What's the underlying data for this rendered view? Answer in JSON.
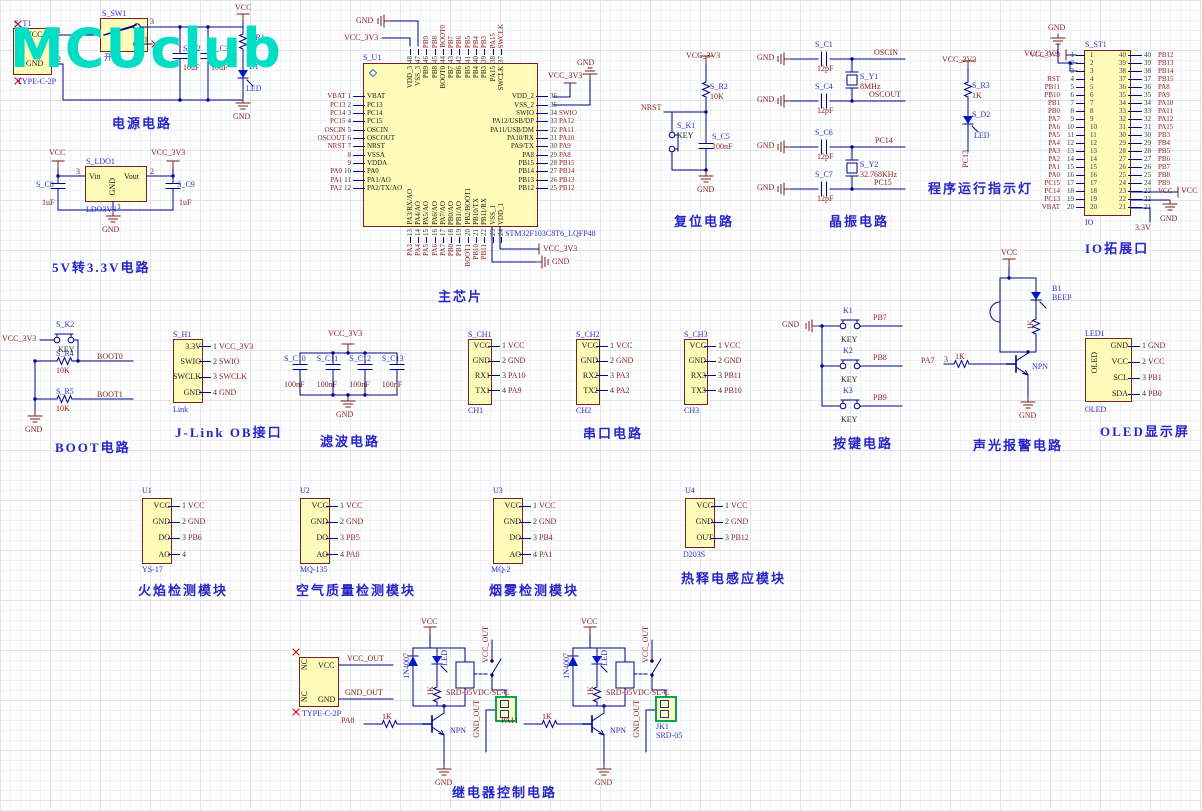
{
  "logo": {
    "text": "MCUclub"
  },
  "power": {
    "title": "电源电路",
    "vcc": "VCC",
    "gnd": "GND",
    "t1_ref": "S_T1",
    "t1_part": "TYPE-C-2P",
    "t1_pin1": "VCC",
    "t1_pin2": "GND",
    "n1": "1",
    "n2": "2",
    "sw_ref": "S_SW1",
    "sw_label": "开关",
    "sw_n3": "3",
    "sw_n1": "1",
    "c2_ref": "S_C2",
    "c2_val": "10uF",
    "c3_ref": "S_C3",
    "c3_val": "10uF",
    "r1_ref": "S_R1",
    "r1_val": "1K",
    "d1_ref": "D1",
    "d1_val": "LED"
  },
  "ldo": {
    "title": "5V转3.3V电路",
    "vcc": "VCC",
    "vcc3": "VCC_3V3",
    "gnd": "GND",
    "ref": "S_LDO1",
    "part": "LDO3V3",
    "vin": "Vin",
    "vout": "Vout",
    "pgnd": "GND",
    "n3": "3",
    "n2": "2",
    "n1": "1",
    "c8_ref": "S_C8",
    "c8_val": "1uF",
    "c9_ref": "S_C9",
    "c9_val": "1uF"
  },
  "chip": {
    "title": "主芯片",
    "ref": "S_U1",
    "part": "STM32F103C8T6_LQFP48",
    "gnd_top": "GND",
    "vcc_top": "VCC_3V3",
    "vcc_right": "VCC_3V3",
    "gnd_right": "GND",
    "vcc_bot": "VCC_3V3",
    "gnd_bot": "GND",
    "left": [
      {
        "num": "1",
        "name": "VBAT",
        "net": "VBAT"
      },
      {
        "num": "2",
        "name": "PC13",
        "net": "PC13"
      },
      {
        "num": "3",
        "name": "PC14",
        "net": "PC14"
      },
      {
        "num": "4",
        "name": "PC15",
        "net": "PC15"
      },
      {
        "num": "5",
        "name": "OSCIN",
        "net": "OSCIN"
      },
      {
        "num": "6",
        "name": "OSCOUT",
        "net": "OSCOUT"
      },
      {
        "num": "7",
        "name": "NRST",
        "net": "NRST"
      },
      {
        "num": "8",
        "name": "VSSA",
        "net": ""
      },
      {
        "num": "9",
        "name": "VDDA",
        "net": ""
      },
      {
        "num": "10",
        "name": "PA0",
        "net": "PA0"
      },
      {
        "num": "11",
        "name": "PA1/AO",
        "net": "PA1"
      },
      {
        "num": "12",
        "name": "PA2/TX/AO",
        "net": "PA2"
      }
    ],
    "top": [
      {
        "num": "48",
        "name": "VDD_3",
        "net": ""
      },
      {
        "num": "47",
        "name": "VSS_3",
        "net": ""
      },
      {
        "num": "46",
        "name": "PB9",
        "net": "PB9"
      },
      {
        "num": "45",
        "name": "PB8",
        "net": "PB8"
      },
      {
        "num": "44",
        "name": "BOOT0",
        "net": "BOOT0"
      },
      {
        "num": "43",
        "name": "PB7",
        "net": "PB7"
      },
      {
        "num": "42",
        "name": "PB6",
        "net": "PB6"
      },
      {
        "num": "41",
        "name": "PB5",
        "net": "PB5"
      },
      {
        "num": "40",
        "name": "PB4",
        "net": "PB4"
      },
      {
        "num": "39",
        "name": "PB3",
        "net": "PB3"
      },
      {
        "num": "38",
        "name": "PA15",
        "net": "PA15"
      },
      {
        "num": "37",
        "name": "SWCLK",
        "net": "SWCLK"
      }
    ],
    "right": [
      {
        "num": "36",
        "name": "VDD_2",
        "net": ""
      },
      {
        "num": "35",
        "name": "VSS_2",
        "net": ""
      },
      {
        "num": "34",
        "name": "SWIO",
        "net": "SWIO"
      },
      {
        "num": "33",
        "name": "PA12/USB/DP",
        "net": "PA12"
      },
      {
        "num": "32",
        "name": "PA11/USB/DM",
        "net": "PA11"
      },
      {
        "num": "31",
        "name": "PA10/RX",
        "net": "PA10"
      },
      {
        "num": "30",
        "name": "PA9/TX",
        "net": "PA9"
      },
      {
        "num": "29",
        "name": "PA8",
        "net": "PA8"
      },
      {
        "num": "28",
        "name": "PB15",
        "net": "PB15"
      },
      {
        "num": "27",
        "name": "PB14",
        "net": "PB14"
      },
      {
        "num": "26",
        "name": "PB13",
        "net": "PB13"
      },
      {
        "num": "25",
        "name": "PB12",
        "net": "PB12"
      }
    ],
    "bottom": [
      {
        "num": "13",
        "name": "PA3/RX/AO",
        "net": "PA3"
      },
      {
        "num": "14",
        "name": "PA4/AO",
        "net": "PA4"
      },
      {
        "num": "15",
        "name": "PA5/AO",
        "net": "PA5"
      },
      {
        "num": "16",
        "name": "PA6/AO",
        "net": "PA6"
      },
      {
        "num": "17",
        "name": "PA7/AO",
        "net": "PA7"
      },
      {
        "num": "18",
        "name": "PB0/AO",
        "net": "PB0"
      },
      {
        "num": "19",
        "name": "PB1/AO",
        "net": "PB1"
      },
      {
        "num": "20",
        "name": "PB2/BOOT1",
        "net": "BOOT1"
      },
      {
        "num": "21",
        "name": "PB10/TX",
        "net": "PB10"
      },
      {
        "num": "22",
        "name": "PB11/RX",
        "net": "PB11"
      },
      {
        "num": "23",
        "name": "VSS_1",
        "net": ""
      },
      {
        "num": "24",
        "name": "VDD_1",
        "net": ""
      }
    ]
  },
  "reset": {
    "title": "复位电路",
    "vcc3": "VCC_3V3",
    "r_ref": "S_R2",
    "r_val": "10K",
    "net": "NRST",
    "k_ref": "S_K1",
    "k_label": "KEY",
    "c_ref": "S_C5",
    "c_val": "100nF",
    "gnd": "GND"
  },
  "crystal": {
    "title": "晶振电路",
    "gnd": "GND",
    "g1": {
      "c_top_ref": "S_C1",
      "c_top_val": "12pF",
      "c_bot_ref": "S_C4",
      "c_bot_val": "12pF",
      "y_ref": "S_Y1",
      "y_val": "8MHz",
      "net_top": "OSCIN",
      "net_bot": "OSCOUT"
    },
    "g2": {
      "c_top_ref": "S_C6",
      "c_top_val": "12pF",
      "c_bot_ref": "S_C7",
      "c_bot_val": "12pF",
      "y_ref": "S_Y2",
      "y_val": "32.768KHz",
      "net_top": "PC14",
      "net_bot": "PC15"
    }
  },
  "runled": {
    "title": "程序运行指示灯",
    "vcc3": "VCC_3V3",
    "r_ref": "S_R3",
    "r_val": "1K",
    "d_ref": "S_D2",
    "d_val": "LED",
    "net": "PC13"
  },
  "io": {
    "title": "IO拓展口",
    "ref": "S_ST1",
    "name": "IO",
    "gnd_top": "GND",
    "vcc3": "VCC_3V3",
    "vcc": "VCC",
    "gnd": "GND",
    "v33": "3.3V",
    "left": [
      {
        "num": "1",
        "net": "VCC_3V3"
      },
      {
        "num": "2",
        "net": ""
      },
      {
        "num": "3",
        "net": ""
      },
      {
        "num": "4",
        "net": "RST"
      },
      {
        "num": "5",
        "net": "PB11"
      },
      {
        "num": "6",
        "net": "PB10"
      },
      {
        "num": "7",
        "net": "PB1"
      },
      {
        "num": "8",
        "net": "PB0"
      },
      {
        "num": "9",
        "net": "PA7"
      },
      {
        "num": "10",
        "net": "PA6"
      },
      {
        "num": "11",
        "net": "PA5"
      },
      {
        "num": "12",
        "net": "PA4"
      },
      {
        "num": "13",
        "net": "PA3"
      },
      {
        "num": "14",
        "net": "PA2"
      },
      {
        "num": "15",
        "net": "PA1"
      },
      {
        "num": "16",
        "net": "PA0"
      },
      {
        "num": "17",
        "net": "PC15"
      },
      {
        "num": "18",
        "net": "PC14"
      },
      {
        "num": "19",
        "net": "PC13"
      },
      {
        "num": "20",
        "net": "VBAT"
      }
    ],
    "right": [
      {
        "num": "40",
        "net": "PB12"
      },
      {
        "num": "39",
        "net": "PB13"
      },
      {
        "num": "38",
        "net": "PB14"
      },
      {
        "num": "37",
        "net": "PB15"
      },
      {
        "num": "36",
        "net": "PA8"
      },
      {
        "num": "35",
        "net": "PA9"
      },
      {
        "num": "34",
        "net": "PA10"
      },
      {
        "num": "33",
        "net": "PA11"
      },
      {
        "num": "32",
        "net": "PA12"
      },
      {
        "num": "31",
        "net": "PA15"
      },
      {
        "num": "30",
        "net": "PB3"
      },
      {
        "num": "29",
        "net": "PB4"
      },
      {
        "num": "28",
        "net": "PB5"
      },
      {
        "num": "27",
        "net": "PB6"
      },
      {
        "num": "26",
        "net": "PB7"
      },
      {
        "num": "25",
        "net": "PB8"
      },
      {
        "num": "24",
        "net": "PB9"
      },
      {
        "num": "23",
        "net": "VCC"
      },
      {
        "num": "22",
        "net": ""
      },
      {
        "num": "21",
        "net": ""
      }
    ]
  },
  "boot": {
    "title": "BOOT电路",
    "vcc3": "VCC_3V3",
    "k_ref": "S_K2",
    "k_label": "KEY",
    "r4_ref": "S_R4",
    "r4_val": "10K",
    "net0": "BOOT0",
    "r5_ref": "S_R5",
    "r5_val": "10K",
    "net1": "BOOT1",
    "gnd": "GND"
  },
  "jlink": {
    "title": "J-Link OB接口",
    "ref": "S_H1",
    "part": "Link",
    "pins": [
      {
        "num": "1",
        "name": "3.3V",
        "net": "VCC_3V3"
      },
      {
        "num": "2",
        "name": "SWIO",
        "net": "SWIO"
      },
      {
        "num": "3",
        "name": "SWCLK",
        "net": "SWCLK"
      },
      {
        "num": "4",
        "name": "GND",
        "net": "GND"
      }
    ]
  },
  "filter": {
    "title": "滤波电路",
    "vcc3": "VCC_3V3",
    "gnd": "GND",
    "caps": [
      {
        "ref": "S_C10",
        "val": "100nF"
      },
      {
        "ref": "S_C11",
        "val": "100nF"
      },
      {
        "ref": "S_C12",
        "val": "100nF"
      },
      {
        "ref": "S_C13",
        "val": "100nF"
      }
    ]
  },
  "serial": {
    "title": "串口电路",
    "channels": [
      {
        "ref": "S_CH1",
        "name": "CH1",
        "pins": [
          {
            "num": "1",
            "name": "VCC",
            "net": "VCC"
          },
          {
            "num": "2",
            "name": "GND",
            "net": "GND"
          },
          {
            "num": "3",
            "name": "RX1",
            "net": "PA10"
          },
          {
            "num": "4",
            "name": "TX1",
            "net": "PA9"
          }
        ]
      },
      {
        "ref": "S_CH2",
        "name": "CH2",
        "pins": [
          {
            "num": "1",
            "name": "VCC",
            "net": "VCC"
          },
          {
            "num": "2",
            "name": "GND",
            "net": "GND"
          },
          {
            "num": "3",
            "name": "RX2",
            "net": "PA3"
          },
          {
            "num": "4",
            "name": "TX2",
            "net": "PA2"
          }
        ]
      },
      {
        "ref": "S_CH3",
        "name": "CH3",
        "pins": [
          {
            "num": "1",
            "name": "VCC",
            "net": "VCC"
          },
          {
            "num": "2",
            "name": "GND",
            "net": "GND"
          },
          {
            "num": "3",
            "name": "RX3",
            "net": "PB11"
          },
          {
            "num": "4",
            "name": "TX3",
            "net": "PB10"
          }
        ]
      }
    ]
  },
  "keys": {
    "title": "按键电路",
    "gnd": "GND",
    "items": [
      {
        "ref": "K1",
        "label": "KEY",
        "net": "PB7"
      },
      {
        "ref": "K2",
        "label": "KEY",
        "net": "PB8"
      },
      {
        "ref": "K3",
        "label": "KEY",
        "net": "PB9"
      }
    ]
  },
  "alarm": {
    "title": "声光报警电路",
    "vcc": "VCC",
    "b_ref": "B1",
    "b_val": "BEEP",
    "r_led": "1K",
    "input": "PA7",
    "n3": "3",
    "rb": "1K",
    "q": "NPN",
    "gnd": "GND"
  },
  "oled": {
    "title": "OLED显示屏",
    "ref": "LED1",
    "part": "OLED",
    "inner": "OLED",
    "pins": [
      {
        "num": "1",
        "name": "GND",
        "net": "GND"
      },
      {
        "num": "2",
        "name": "VCC",
        "net": "VCC"
      },
      {
        "num": "3",
        "name": "SCL",
        "net": "PB1"
      },
      {
        "num": "4",
        "name": "SDA",
        "net": "PB0"
      }
    ]
  },
  "flame": {
    "title": "火焰检测模块",
    "ref": "U1",
    "part": "YS-17",
    "pins": [
      {
        "num": "1",
        "name": "VCC",
        "net": "VCC"
      },
      {
        "num": "2",
        "name": "GND",
        "net": "GND"
      },
      {
        "num": "3",
        "name": "DO",
        "net": "PB6"
      },
      {
        "num": "4",
        "name": "AO",
        "net": ""
      }
    ]
  },
  "air": {
    "title": "空气质量检测模块",
    "ref": "U2",
    "part": "MQ-135",
    "pins": [
      {
        "num": "1",
        "name": "VCC",
        "net": "VCC"
      },
      {
        "num": "2",
        "name": "GND",
        "net": "GND"
      },
      {
        "num": "3",
        "name": "DO",
        "net": "PB5"
      },
      {
        "num": "4",
        "name": "AO",
        "net": "PA0"
      }
    ]
  },
  "smoke": {
    "title": "烟雾检测模块",
    "ref": "U3",
    "part": "MQ-2",
    "pins": [
      {
        "num": "1",
        "name": "VCC",
        "net": "VCC"
      },
      {
        "num": "2",
        "name": "GND",
        "net": "GND"
      },
      {
        "num": "3",
        "name": "DO",
        "net": "PB4"
      },
      {
        "num": "4",
        "name": "AO",
        "net": "PA1"
      }
    ]
  },
  "pir": {
    "title": "热释电感应模块",
    "ref": "U4",
    "part": "D203S",
    "pins": [
      {
        "num": "1",
        "name": "VCC",
        "net": "VCC"
      },
      {
        "num": "2",
        "name": "GND",
        "net": "GND"
      },
      {
        "num": "3",
        "name": "OUT",
        "net": "PB12"
      }
    ]
  },
  "relay": {
    "title": "继电器控制电路",
    "vcc": "VCC",
    "gnd": "GND",
    "tc_part": "TYPE-C-2P",
    "tc_nc": "NC",
    "tc_vcc": "VCC",
    "tc_gnd": "GND",
    "tc_vout": "VCC_OUT",
    "tc_gout": "GND_OUT",
    "d1": {
      "diode": "1N4007",
      "led": "LED",
      "r": "1K",
      "relay": "SRD-05VDC-SL-C",
      "vout": "VCC_OUT",
      "gout": "GND_OUT",
      "input": "PA8",
      "rb": "1K",
      "q": "NPN"
    },
    "d2": {
      "diode": "1N4007",
      "led": "LED",
      "r": "1K",
      "relay": "SRD-05VDC-SL-C",
      "vout": "VCC_OUT",
      "gout": "GND_OUT",
      "input": "PA11",
      "rb": "1K",
      "q": "NPN",
      "jk_ref": "JK1",
      "jk_part": "SRD-05"
    }
  }
}
